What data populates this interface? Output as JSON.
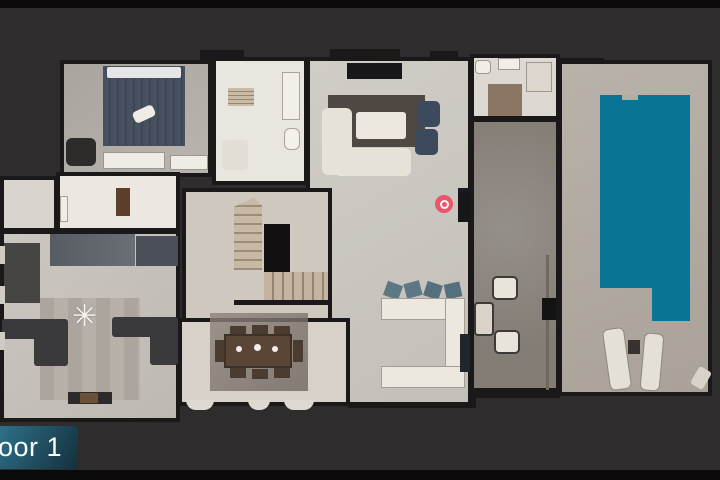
{
  "app": {
    "view": "floor-plan"
  },
  "floor_banner": {
    "label": "Floor 1"
  },
  "marker": {
    "x": 444,
    "y": 204
  },
  "colors": {
    "bg": "#2e2c2d",
    "letterbox": "#0a0a0a",
    "pool": "#0a7496",
    "marker": "#ee4d63",
    "banner_a": "#4b93ab",
    "banner_b": "#2c6c84",
    "banner_c": "#14303c"
  },
  "icons": {
    "ceiling_fan": "✳",
    "position_marker": "target-ring"
  }
}
